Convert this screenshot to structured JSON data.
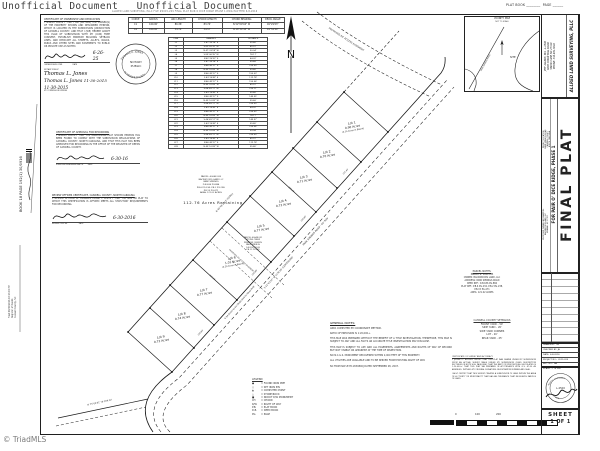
{
  "watermark": {
    "text": "Unofficial Document"
  },
  "footer": {
    "copyright": "© TriadMLS"
  },
  "file_header": "ALLRED LAND SURVEYING, PLLC FILE #2015-209 FINAL PLAT PAIR O DICE RIDGE PHASE 1.DWG PLOTTED 6-8-2016",
  "plat_book": {
    "label": "PLAT BOOK ________  PAGE ______"
  },
  "recording_stamp": {
    "book_line": "BOOK 18 PAGE 192(1)   30/0916",
    "filed_lines": [
      "Filed 06/30/2016 03:13:19 PM",
      "Register of Deeds",
      "Caswell County, NC"
    ]
  },
  "certificates": {
    "ownership": {
      "title": "CERTIFICATE OF OWNERSHIP AND DEDICATION",
      "body": "I HEREBY CERTIFY THAT I AM (WE ARE) THE OWNER(S) OF THE PROPERTY SHOWN AND DESCRIBED HEREON, WHICH IS LOCATED IN THE SUBDIVISION JURISDICTION OF CASWELL COUNTY, AND THAT I (WE) HEREBY ADOPT THIS PLAN OF SUBDIVISION WITH MY (OUR) FREE CONSENT, ESTABLISH MINIMUM BUILDING SETBACK LINES, AND DEDICATE ALL STREETS, ALLEYS, WALKS, PARKS AND OTHER SITES AND EASEMENTS TO PUBLIC OR PRIVATE USE AS NOTED.",
      "date_script": "6-26-25",
      "caption": "OWNER/DEVELOPER                  DATE"
    },
    "notary": {
      "caption": "NOTARY PUBLIC",
      "name_script": "Thomas L. Jones",
      "date_script": "11-30-2015",
      "name_script2": "Thomas L. Jones",
      "date_script2": "11-30-2015",
      "line2": "MY COMMISSION EXPIRES"
    },
    "recording": {
      "title": "CERTIFICATE OF APPROVAL FOR RECORDING",
      "body": "I HEREBY CERTIFY THAT THE SUBDIVISION PLAT SHOWN HEREON HAS BEEN FOUND TO COMPLY WITH THE SUBDIVISION REGULATIONS OF CASWELL COUNTY, NORTH CAROLINA, AND THAT THIS PLAT HAS BEEN APPROVED FOR RECORDING IN THE OFFICE OF THE REGISTER OF DEEDS OF CASWELL COUNTY.",
      "date_script": "6-30-16",
      "caption": "SUBDIVISION ADMINISTRATOR        DATE"
    },
    "review": {
      "title": "REVIEW OFFICER CERTIFICATE, CASWELL COUNTY, NORTH CAROLINA",
      "body": "I, REVIEW OFFICER OF CASWELL COUNTY, CERTIFY THAT THE MAP OR PLAT TO WHICH THIS CERTIFICATION IS AFFIXED MEETS ALL STATUTORY REQUIREMENTS FOR RECORDING.",
      "date_script": "6-30-2016",
      "caption": "REVIEW OFFICER                    DATE"
    }
  },
  "notary_seal": {
    "top": "THOMAS E. JONES",
    "center1": "NOTARY",
    "center2": "PUBLIC",
    "bottom": "ALAMANCE COUNTY"
  },
  "curve_table": {
    "headers": [
      "CURVE",
      "RADIUS",
      "ARC LENGTH",
      "CHORD LENGTH",
      "CHORD BEARING",
      "DELTA ANGLE"
    ],
    "rows": [
      [
        "C1",
        "100.00'",
        "86.36'",
        "83.74'",
        "N 52°09'04\" W",
        "49°29'03\""
      ],
      [
        "C2",
        "100.00'",
        "34.74'",
        "34.57'",
        "N 18°39'38\" W",
        "19°54'20\""
      ]
    ]
  },
  "line_table": {
    "headers": [
      "LINE",
      "BEARING",
      "DISTANCE"
    ],
    "rows": [
      [
        "L1",
        "S 47°33'28\" E",
        "35.80'"
      ],
      [
        "L2",
        "S 42°26'32\" W",
        "65.07'"
      ],
      [
        "L3",
        "N 47°33'28\" W",
        "30.04'"
      ],
      [
        "L4",
        "S 89°06'35\" W",
        "78.17'"
      ],
      [
        "L5",
        "N 42°26'32\" E",
        "64.02'"
      ],
      [
        "L6",
        "S 47°33'28\" E",
        "59.66'"
      ],
      [
        "L7",
        "N 46°49'17\" E",
        "150.00'"
      ],
      [
        "L8",
        "N 43°10'43\" W",
        "59.80'"
      ],
      [
        "L9",
        "N 46°49'17\" E",
        "150.03'"
      ],
      [
        "L10",
        "S 43°10'43\" E",
        "112.78'"
      ],
      [
        "L11",
        "N 46°49'17\" E",
        "150.06'"
      ],
      [
        "L12",
        "N 43°10'43\" W",
        "65.07'"
      ],
      [
        "L13",
        "S 46°49'17\" W",
        "150.11'"
      ],
      [
        "L14",
        "S 43°10'43\" E",
        "35.80'"
      ],
      [
        "L15",
        "N 46°49'17\" E",
        "149.95'"
      ],
      [
        "L16",
        "N 43°10'43\" W",
        "59.66'"
      ],
      [
        "L17",
        "S 46°49'17\" W",
        "150.00'"
      ],
      [
        "L18",
        "S 43°10'43\" E",
        "64.02'"
      ],
      [
        "L19",
        "N 46°49'17\" E",
        "150.03'"
      ],
      [
        "L20",
        "N 43°10'43\" W",
        "78.17'"
      ],
      [
        "L21",
        "S 46°49'17\" W",
        "149.97'"
      ],
      [
        "L22",
        "S 43°10'43\" E",
        "59.80'"
      ],
      [
        "L23",
        "N 46°49'17\" E",
        "150.06'"
      ],
      [
        "L24",
        "N 43°10'43\" W",
        "30.04'"
      ],
      [
        "L25",
        "S 46°49'17\" W",
        "150.00'"
      ],
      [
        "L26",
        "S 43°10'43\" E",
        "65.07'"
      ],
      [
        "L27",
        "N 46°49'17\" E",
        "112.78'"
      ],
      [
        "L28",
        "N 43°10'43\" W",
        "35.80'"
      ]
    ]
  },
  "north": {
    "label": "N"
  },
  "lots": [
    {
      "name": "Lot 1",
      "acres": "0.90 Acres",
      "note": "(0.14 Acres in Easmt)"
    },
    {
      "name": "Lot 2",
      "acres": "0.70 Acres",
      "note": ""
    },
    {
      "name": "Lot 3",
      "acres": "0.71 Acres",
      "note": ""
    },
    {
      "name": "Lot 4",
      "acres": "0.72 Acres",
      "note": ""
    },
    {
      "name": "Lot 5",
      "acres": "0.77 Acres",
      "note": ""
    },
    {
      "name": "Lot 6",
      "acres": "1.01 Acres",
      "note": "(0.29 Acres in Easmt)"
    },
    {
      "name": "Lot 7",
      "acres": "0.77 Acres",
      "note": ""
    },
    {
      "name": "Lot 8",
      "acres": "0.74 Acres",
      "note": ""
    },
    {
      "name": "Lot 9",
      "acres": "0.72 Acres",
      "note": ""
    }
  ],
  "remaining_parcel": {
    "lines": [
      "PARCEL #0048 035",
      "BACKWOODS LAND LLC",
      "PARK SPRINGS",
      "D.B.636 PG.884",
      "P.B.6 PG.234, P.B.2 PG.238,",
      "P.B.15 PG.471",
      "AREA: 121.02 ACRES"
    ],
    "remaining": "112.76  Acres  Remaining"
  },
  "church_parcel": {
    "lines": [
      "PARCEL #0048 031",
      "MOONS CREEK",
      "PRIMITIVE CHURCH",
      "PARK SPRINGS",
      "D.B.230 PG.83",
      "P.B.11 PG.289"
    ]
  },
  "parcel_notes": {
    "title": "PARCEL NOTES:",
    "lines": [
      "PARCEL #: 0048 035",
      "OWNER: BACKWOODS LAND, LLC",
      "ADDRESS: PARK SPRINGS ROAD",
      "DEED REF.: D.B.636 PG.884",
      "PLAT REF.: P.B.6 PG.234, P.B.2 PG.238,",
      "P.B.15 PG.471",
      "AREA: 121.02 ACRES"
    ]
  },
  "road": {
    "name_rw": "PARK SPRINGS ROAD - 60' R/W",
    "centerline": "S 41°43'07\" W   1178.38'   (CENTERLINE)",
    "dedication": "0.94 Acres to be Dedicated to Road R/W",
    "bottom_bearing": "N 73°04'41\" W  284.32'"
  },
  "easement_label": "PROPOSED 60' ACCESS EASEMENT",
  "bearings": {
    "rear_total": "N 46°49'17\" E   (TOTAL)",
    "front_dims": [
      "150.03'",
      "150.00'",
      "150.06'",
      "155.43'"
    ],
    "div_dims": [
      "305.96'",
      "299.58'"
    ]
  },
  "general_notes": {
    "title": "GENERAL NOTES:",
    "notes": [
      "AREA COMPUTED BY COORDINATE METHOD.",
      "RATIO OF PRECISION IS 1:20,000+.",
      "THIS MAP WAS PREPARED WITHOUT THE BENEFIT OF A TITLE INVESTIGATION, THEREFORE, THIS MAP IS SUBJECT TO ANY AND ALL FACTS AN ACCURATE TITLE INVESTIGATION MAY DISCLOSE.",
      "THIS MAP IS SUBJECT TO ANY AND ALL EASEMENTS, AGREEMENTS AND RIGHTS OF WAY OF RECORD BUT NOT VISIBLE OR APPARENT AT THE TIME OF INSPECTION.",
      "NO N.C.G.S. MONUMENT RECOVERED WITHIN 2,000 FEET OF THIS PROPERTY.",
      "ALL UTILITIES ARE AVAILABLE AND TO BE SERVED FROM EXISTING RIGHT OF WAY.",
      "NC FIRM MAP #3711830800J DATED SEPTEMBER 28, 2007."
    ]
  },
  "setbacks": {
    "title": "CASWELL COUNTY SETBACKS",
    "lines": [
      "FRONT YARD  -  50'",
      "SIDE YARD  -  20'",
      "SIDE YARD CORNER",
      "LOT  -  20'",
      "REAR YARD  -  25'"
    ]
  },
  "survey_certificate": {
    "title": "CERTIFICATE OF SURVEY AND ACCURACY",
    "body": "I, JEFFREY L. ALLRED, CERTIFY THAT THIS PLAT WAS DRAWN UNDER MY SUPERVISION FROM AN ACTUAL SURVEY MADE UNDER MY SUPERVISION (DEED DESCRIPTION RECORDED IN BOOK 636, PAGE 884); THAT THE RATIO OF PRECISION AS CALCULATED IS 1:20,000+; THAT THIS PLAT WA PREPARED IN ACCORDANCE WITH G.S. 47-30 AS AMENDED. WITNESS MY ORIGINAL SIGNATURE, REGISTRATION NUMBER AND SEAL.",
    "body2": "I ALSO CERTIFY THAT THIS SURVEY CREATES A SUBDIVISION OF LAND WITHIN THE AREA OF A COUNTY OR MUNICIPALITY THAT HAS AN ORDINANCE THAT REGULATES PARCELS OF LAND."
  },
  "legend": {
    "title": "LEGEND",
    "items": [
      {
        "sym": "●",
        "text": "=  FOUND IRON PIPE"
      },
      {
        "sym": "○",
        "text": "=  SET IRON PIN"
      },
      {
        "sym": "▲",
        "text": "=  COMPUTED POINT"
      },
      {
        "sym": "△",
        "text": "=  STONE/ROCK"
      },
      {
        "sym": "■",
        "text": "=  NCDOT R/W MONUMENT"
      },
      {
        "sym": "CH",
        "text": "=  CHORD"
      },
      {
        "sym": "R/W",
        "text": "=  RIGHT OF WAY"
      },
      {
        "sym": "P.B.",
        "text": "=  PLAT BOOK"
      },
      {
        "sym": "D.B.",
        "text": "=  DEED BOOK"
      },
      {
        "sym": "PG.",
        "text": "=  PAGE"
      }
    ]
  },
  "scale_bar": {
    "labels": [
      "0",
      "100",
      "200"
    ]
  },
  "vicinity": {
    "title": "VICINITY MAP",
    "subtitle": "NOT TO SCALE",
    "site": "SITE",
    "road": "PARK SPRINGS ROAD"
  },
  "titleblock": {
    "firm": "ALLRED LAND SURVEYING, PLLC",
    "firm_lines": [
      "JEFF ALLRED, PLS - L-4500",
      "6065 COBLE MILL ROAD",
      "SNOW CAMP, NC 27349",
      "PHONE: 336-684-8202"
    ],
    "title": "FINAL PLAT",
    "subtitle": "FOR PAIR O' DICE RIDGE, PHASE 1",
    "project_location": [
      "PROJECT LOCATION:",
      "PARK SPRINGS ROAD",
      "CASWELL COUNTY",
      "NORTH CAROLINA"
    ],
    "owner_info": [
      "PROPOSED OWNER INFORMATION:",
      "BACKWOODS LAND, LLC",
      "MEBANE, NC 27302"
    ],
    "revisions_header": "REVISIONS",
    "fields": [
      [
        "DRAWN BY:",
        "TW"
      ],
      [
        "CHECKED BY:",
        "JA"
      ],
      [
        "DATE:",
        "6-8-2016"
      ],
      [
        "PROJECT NO.:",
        "2015-209"
      ],
      [
        "REC. NO.:",
        "NA"
      ],
      [
        "SCALE:",
        "1\" = 200'"
      ]
    ],
    "seal": {
      "top": "NORTH CAROLINA",
      "center": "L-4500",
      "bottom": "SEAL"
    },
    "sheet_label": "SHEET",
    "sheet_number": "1 OF 1"
  }
}
